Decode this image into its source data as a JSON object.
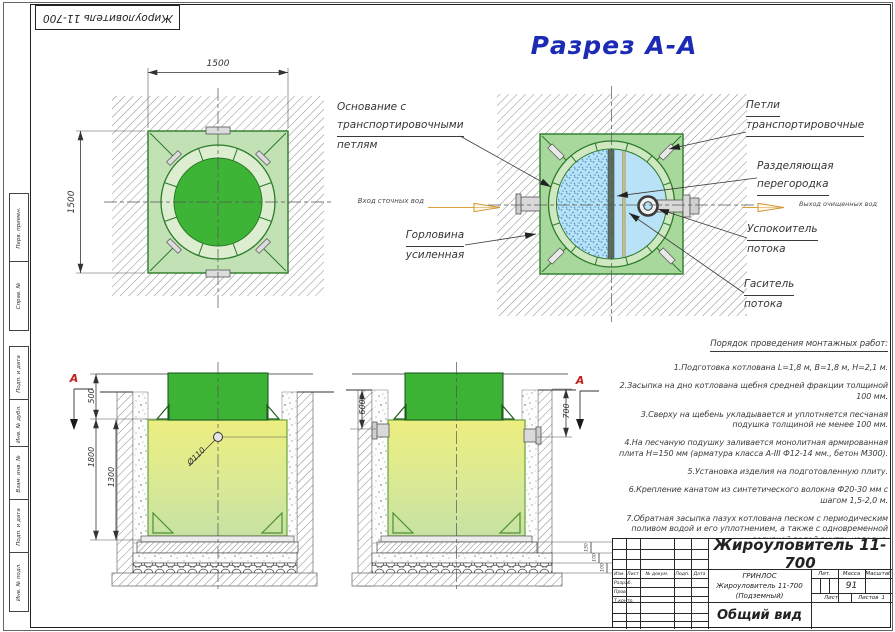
{
  "frame": {
    "corner_stamp": "Жироуловитель 11-700",
    "side_cells": [
      "Перв. примен.",
      "Справ. №",
      "Подп. и дата",
      "Инв. № дубл.",
      "Взам. инв. №",
      "Подп. и дата",
      "Инв. № подл."
    ]
  },
  "section_title": "Разрез А-А",
  "plan": {
    "dim_top": "1500",
    "dim_left": "1500"
  },
  "section": {
    "callout_base": [
      "Основание с",
      "транспортировочными",
      "петлям"
    ],
    "callout_neck": [
      "Горловина",
      "усиленная"
    ],
    "callout_loops": [
      "Петли",
      "транспортировочные"
    ],
    "callout_partition": [
      "Разделяющая",
      "перегородка"
    ],
    "callout_stiller": [
      "Успокоитель",
      "потока"
    ],
    "callout_damper": [
      "Гаситель",
      "потока"
    ],
    "inlet_label": "Вход сточных вод",
    "outlet_label": "Выход очищенных вод"
  },
  "elevation_left": {
    "marker": "А",
    "dim_neck": "500",
    "dim_depth": "1800",
    "dim_body": "1300",
    "dim_pipe": "Ø110"
  },
  "elevation_right": {
    "marker": "А",
    "dim_left": "600",
    "dim_right": "700",
    "dim_plate": "150",
    "dim_sand": "100",
    "dim_gravel": "100"
  },
  "notes": {
    "heading": "Порядок проведения монтажных работ:",
    "items": [
      "1.Подготовка котлована L=1,8 м, В=1,8 м, Н=2,1 м.",
      "2.Засыпка на дно котлована щебня средней фракции толщиной 100 мм.",
      "3.Сверху на щебень укладывается и уплотняется песчаная подушка толщиной не менее 100 мм.",
      "4.На песчаную подушку заливается монолитная армированная плита Н=150 мм (арматура класса А-III Ф12-14 мм., бетон М300).",
      "5.Установка изделия на подготовленную плиту.",
      "6.Крепление канатом из синтетического волокна Ф20-30 мм с шагом 1,5-2,0 м.",
      "7.Обратная засыпка пазух котлована песком с периодическим поливом водой и его уплотнением, а также с одновременной заливкой водой внутрь изделия."
    ]
  },
  "title_block": {
    "product": "Жироуловитель 11-700",
    "company": "ГРИНЛОС",
    "product_name": "Жироуловитель 11-700",
    "product_type": "(Подземный)",
    "view": "Общий вид",
    "mass_value": "91",
    "labels": {
      "izm": "Изм.",
      "list": "Лист",
      "doc": "№ докум.",
      "podp": "Подп.",
      "data": "Дата",
      "razrab": "Разраб.",
      "prov": "Пров.",
      "tkontr": "Т.контр.",
      "lit": "Лит.",
      "massa": "Масса",
      "scale": "Масштаб",
      "sheet": "Лист",
      "sheets": "Листов",
      "sheets_value": "1"
    }
  }
}
